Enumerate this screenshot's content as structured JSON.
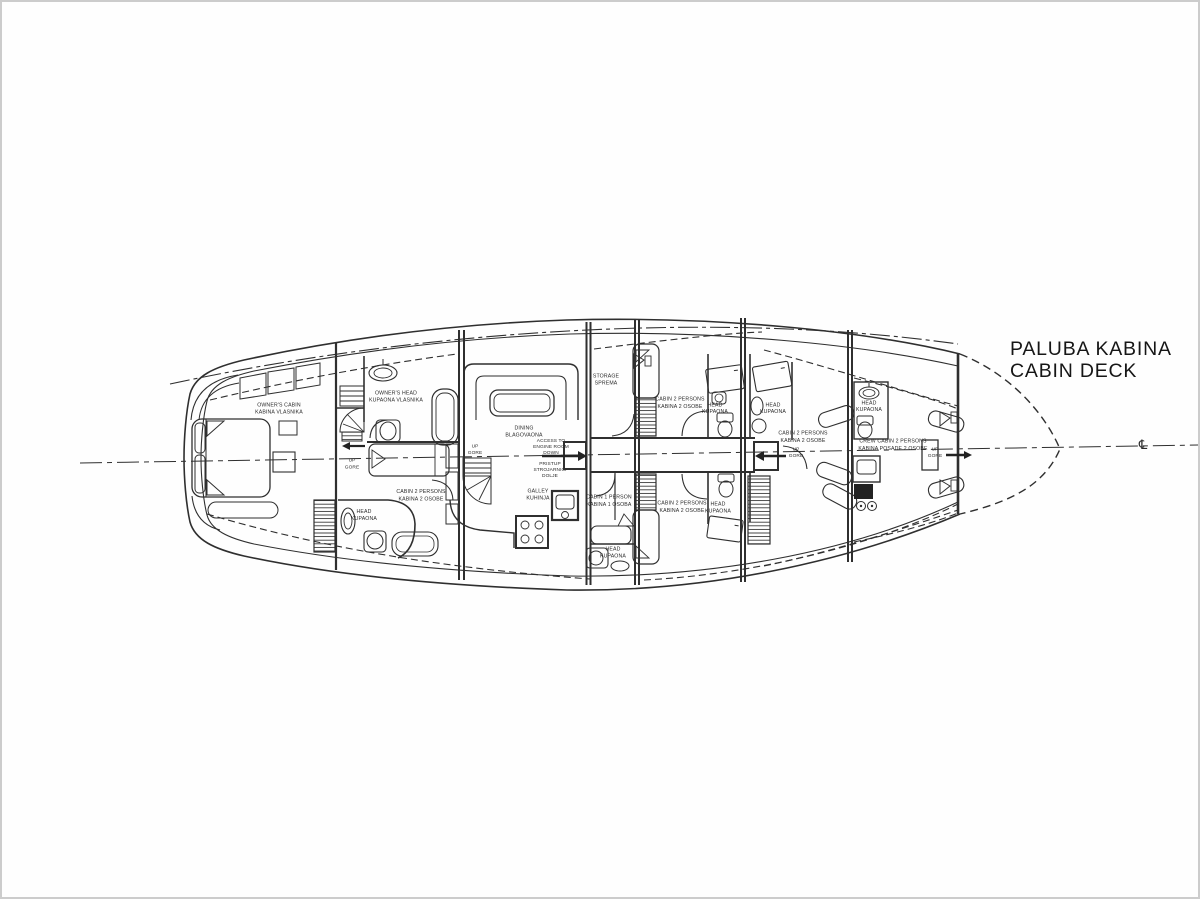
{
  "title": {
    "primary": "PALUBA KABINA",
    "secondary": "CABIN DECK"
  },
  "symbols": {
    "centerline": "℄"
  },
  "colors": {
    "ink": "#2f2f2f",
    "paper": "#fefefe",
    "frame": "#cccccc"
  },
  "labels": {
    "owners_cabin_en": "OWNER'S CABIN",
    "owners_cabin_hr": "KABINA VLASNIKA",
    "owners_head_en": "OWNER'S HEAD",
    "owners_head_hr": "KUPAONA VLASNIKA",
    "cabin2_en": "CABIN 2 PERSONS",
    "cabin2_hr": "KABINA 2 OSOBE",
    "cabin1_en": "CABIN 1 PERSON",
    "cabin1_hr": "KABINA 1 OSOBA",
    "crew_cabin_en": "CREW CABIN 2 PERSONS",
    "crew_cabin_hr": "KABINA POSADE 2 OSOBE",
    "head_en": "HEAD",
    "head_hr": "KUPAONA",
    "dining_en": "DINING",
    "dining_hr": "BLAGOVAONA",
    "galley_en": "GALLEY",
    "galley_hr": "KUHINJA",
    "storage_en": "STORAGE",
    "storage_hr": "SPREMA",
    "up_en": "UP",
    "up_hr": "GORE",
    "access_en_1": "ACCESS TO",
    "access_en_2": "ENGINE ROOM",
    "access_en_3": "DOWN",
    "access_hr_1": "PRISTUP",
    "access_hr_2": "STROJARNICI",
    "access_hr_3": "DOLJE"
  }
}
